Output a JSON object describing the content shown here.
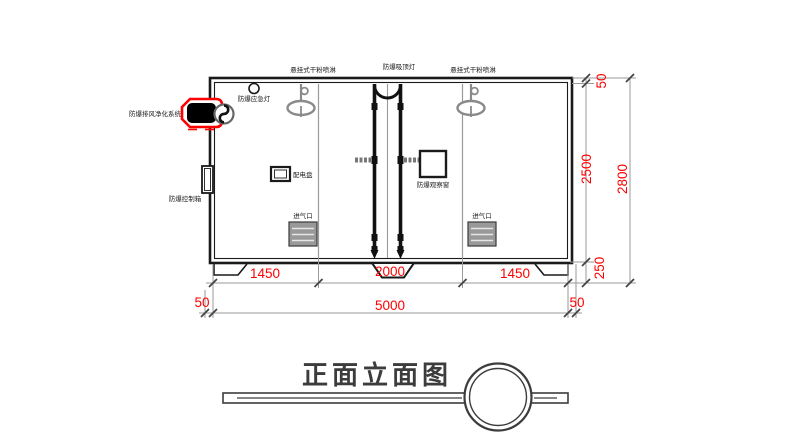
{
  "drawing": {
    "title": "正面立面图",
    "labels": {
      "sprinkler_left": "悬挂式干粉喷淋",
      "ceiling_lamp": "防爆吸顶灯",
      "sprinkler_right": "悬挂式干粉喷淋",
      "emergency_lamp": "防爆应急灯",
      "exhaust_purifier": "防爆排风净化系统",
      "control_box": "防爆控制箱",
      "distribution_board": "配电盘",
      "observation_window": "防爆观察窗",
      "air_inlet_left": "进气口",
      "air_inlet_right": "进气口"
    },
    "dimensions": {
      "bottom_segments": [
        "1450",
        "2000",
        "1450"
      ],
      "bottom_left_margin": "50",
      "bottom_total": "5000",
      "bottom_right_margin": "50",
      "right_top": "50",
      "right_inner_height": "2500",
      "right_total": "2800",
      "right_base": "250"
    },
    "colors": {
      "dimension_red": "#ff0000",
      "highlight_red": "#ff0000",
      "line_black": "#1a1a1a",
      "line_gray": "#8a8a8a"
    }
  }
}
